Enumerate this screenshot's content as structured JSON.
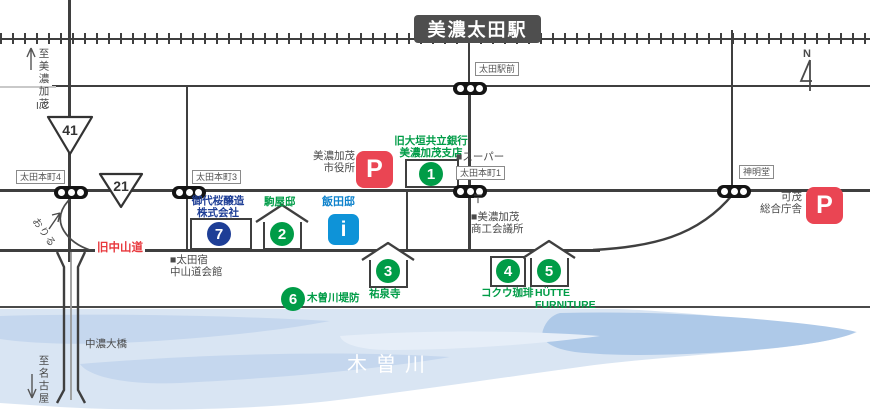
{
  "colors": {
    "green": "#009c47",
    "navy": "#1e3e96",
    "azure": "#0e93d8",
    "azureText": "#0d82cc",
    "red": "#e8383d",
    "parking": "#ea4553",
    "station": "#4e4e4e",
    "road": "#3f3f3f",
    "ink": "#4a4a4a",
    "river1": "#d9e5f3",
    "river2": "#c5d7ee",
    "river3": "#aec9e8"
  },
  "station": {
    "name": "美濃太田駅"
  },
  "compass": {
    "north": "N"
  },
  "directions": {
    "to_ic": "至美濃加茂",
    "to_ic_suffix": "I.C",
    "to_nagoya": "至名古屋"
  },
  "route_shields": {
    "r41": "41",
    "r21": "21"
  },
  "intersections": {
    "hon4": "太田本町4",
    "hon3": "太田本町3",
    "ekimae": "太田駅前",
    "hon1": "太田本町1",
    "shinmeido": "神明堂"
  },
  "roads": {
    "old_nakasendo": "旧中山道",
    "ramp": "おりる"
  },
  "river": {
    "name": "木曽川",
    "bridge": "中濃大橋"
  },
  "landmarks": {
    "city_hall": "美濃加茂\n市役所",
    "supermarket": "■スーパー",
    "post_office": "〒",
    "chamber": "■美濃加茂\n 商工会議所",
    "otajuku_hall": "■太田宿\n 中山道会館",
    "kamo_gov": "可茂\n総合庁舎"
  },
  "parking": {
    "label": "P"
  },
  "info_spot": {
    "name": "飯田邸",
    "icon": "i"
  },
  "numbered_spots": [
    {
      "no": "1",
      "name": "旧大垣共立銀行\n美濃加茂支店"
    },
    {
      "no": "2",
      "name": "駒屋邸"
    },
    {
      "no": "3",
      "name": "祐泉寺"
    },
    {
      "no": "4",
      "name": "コクウ珈琲"
    },
    {
      "no": "5",
      "name": "HÜTTE\nFURNITURE"
    },
    {
      "no": "6",
      "name": "木曽川堤防"
    },
    {
      "no": "7",
      "name": "御代桜醸造\n株式会社"
    }
  ]
}
